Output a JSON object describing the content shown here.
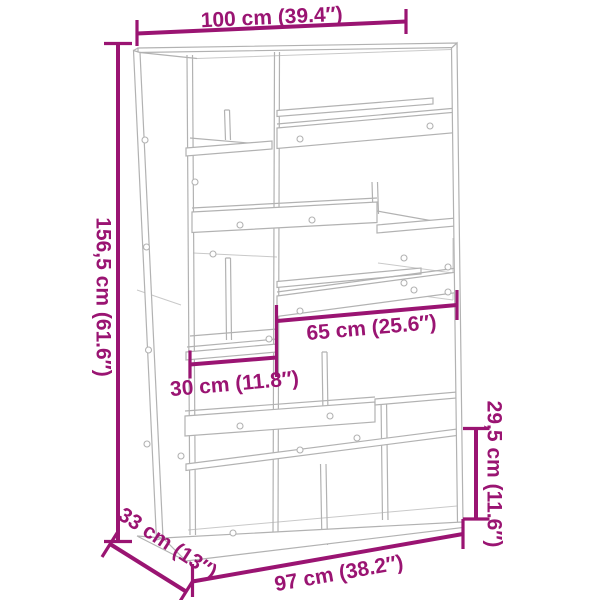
{
  "diagram": {
    "type": "furniture-dimension-diagram",
    "product": "room divider bookshelf line drawing",
    "accent_color": "#9a1472",
    "furniture_line_color": "#b2b2b2",
    "background_color": "#ffffff",
    "dimensions": {
      "top_width": "100 cm (39.4″)",
      "height": "156,5 cm (61.6″)",
      "middle_shelf_width": "65 cm (25.6″)",
      "small_shelf_width": "30 cm (11.8″)",
      "compartment_height": "29,5 cm (11.6″)",
      "depth": "33 cm (13″)",
      "bottom_width": "97 cm (38.2″)"
    }
  }
}
